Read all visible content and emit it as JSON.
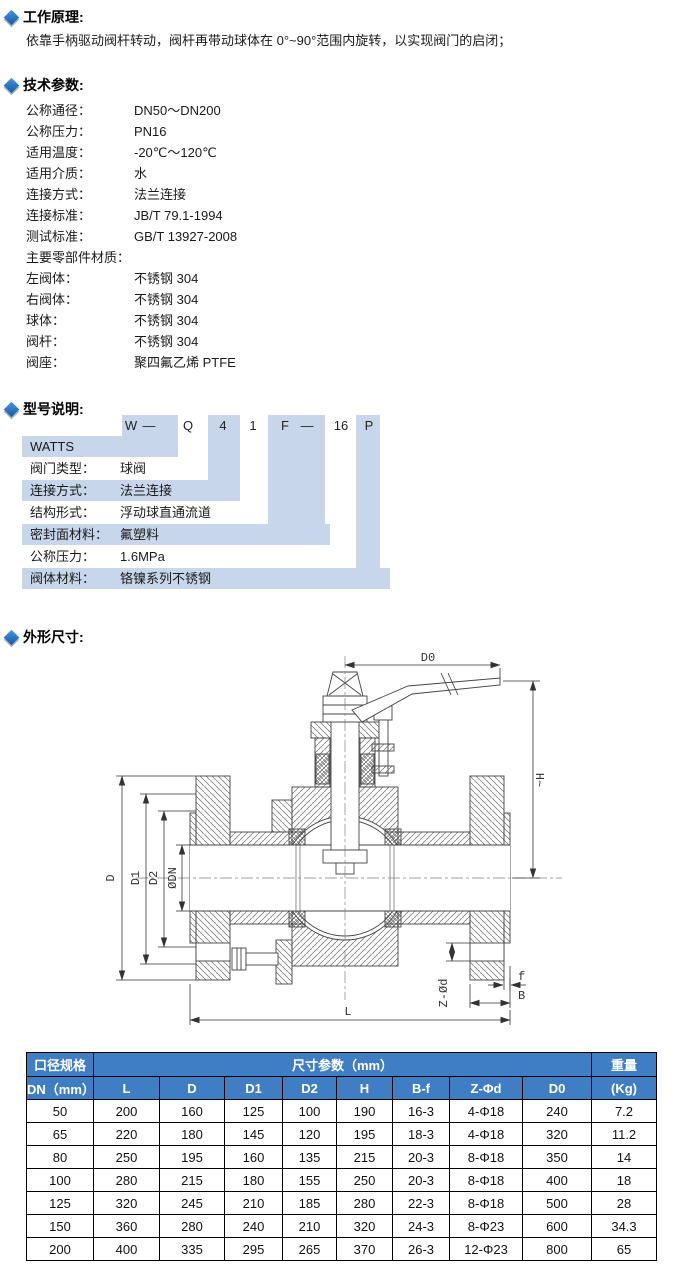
{
  "sections": {
    "principle": {
      "title": "工作原理:",
      "body": "依靠手柄驱动阀杆转动，阀杆再带动球体在 0°~90°范围内旋转，以实现阀门的启闭；"
    },
    "tech": {
      "title": "技术参数:",
      "params": [
        {
          "label": "公称通径：",
          "value": "DN50～DN200"
        },
        {
          "label": "公称压力：",
          "value": "PN16"
        },
        {
          "label": "适用温度：",
          "value": "-20℃～120℃"
        },
        {
          "label": "适用介质：",
          "value": "水"
        },
        {
          "label": "连接方式：",
          "value": "法兰连接"
        },
        {
          "label": "连接标准：",
          "value": "JB/T 79.1-1994"
        },
        {
          "label": "测试标准：",
          "value": "GB/T 13927-2008"
        },
        {
          "label": "主要零部件材质：",
          "value": ""
        },
        {
          "label": "左阀体：",
          "value": "不锈钢 304"
        },
        {
          "label": "右阀体：",
          "value": "不锈钢 304"
        },
        {
          "label": "球体：",
          "value": "不锈钢 304"
        },
        {
          "label": "阀杆：",
          "value": "不锈钢 304"
        },
        {
          "label": "阀座：",
          "value": "聚四氟乙烯 PTFE"
        }
      ]
    },
    "model": {
      "title": "型号说明:",
      "code": [
        "W",
        "—",
        "Q",
        "4",
        "1",
        "F",
        "—",
        "16",
        "P"
      ],
      "rows": [
        {
          "label": "WATTS",
          "value": ""
        },
        {
          "label": "阀门类型：",
          "value": "球阀"
        },
        {
          "label": "连接方式：",
          "value": "法兰连接"
        },
        {
          "label": "结构形式：",
          "value": "浮动球直通流道"
        },
        {
          "label": "密封面材料：",
          "value": "氟塑料"
        },
        {
          "label": "公称压力：",
          "value": "1.6MPa"
        },
        {
          "label": "阀体材料：",
          "value": "铬镍系列不锈钢"
        }
      ]
    },
    "dims": {
      "title": "外形尺寸:"
    }
  },
  "drawing": {
    "labels": {
      "d0": "D0",
      "h": "~H",
      "d": "D",
      "d1": "D1",
      "d2": "D2",
      "dn": "ØDN",
      "zd": "Z-Ød",
      "f": "f",
      "b": "B",
      "l": "L"
    }
  },
  "table": {
    "col1_header_top": "口径规格",
    "col1_header_bottom": "DN（mm）",
    "group_header": "尺寸参数（mm）",
    "weight_header_top": "重量",
    "weight_header_bottom": "(Kg)",
    "dim_columns": [
      "L",
      "D",
      "D1",
      "D2",
      "H",
      "B-f",
      "Z-Φd",
      "D0"
    ],
    "rows": [
      [
        "50",
        "200",
        "160",
        "125",
        "100",
        "190",
        "16-3",
        "4-Φ18",
        "240",
        "7.2"
      ],
      [
        "65",
        "220",
        "180",
        "145",
        "120",
        "195",
        "18-3",
        "4-Φ18",
        "320",
        "11.2"
      ],
      [
        "80",
        "250",
        "195",
        "160",
        "135",
        "215",
        "20-3",
        "8-Φ18",
        "350",
        "14"
      ],
      [
        "100",
        "280",
        "215",
        "180",
        "155",
        "250",
        "20-3",
        "8-Φ18",
        "400",
        "18"
      ],
      [
        "125",
        "320",
        "245",
        "210",
        "185",
        "280",
        "22-3",
        "8-Φ18",
        "500",
        "28"
      ],
      [
        "150",
        "360",
        "280",
        "240",
        "210",
        "320",
        "24-3",
        "8-Φ23",
        "600",
        "34.3"
      ],
      [
        "200",
        "400",
        "335",
        "295",
        "265",
        "370",
        "26-3",
        "12-Φ23",
        "800",
        "65"
      ]
    ]
  },
  "colors": {
    "accent_blue": "#2d7bc9",
    "diagram_shade": "#c7d6ea",
    "table_header_bg": "#3f7dc4",
    "table_header_text": "#ffffff"
  }
}
